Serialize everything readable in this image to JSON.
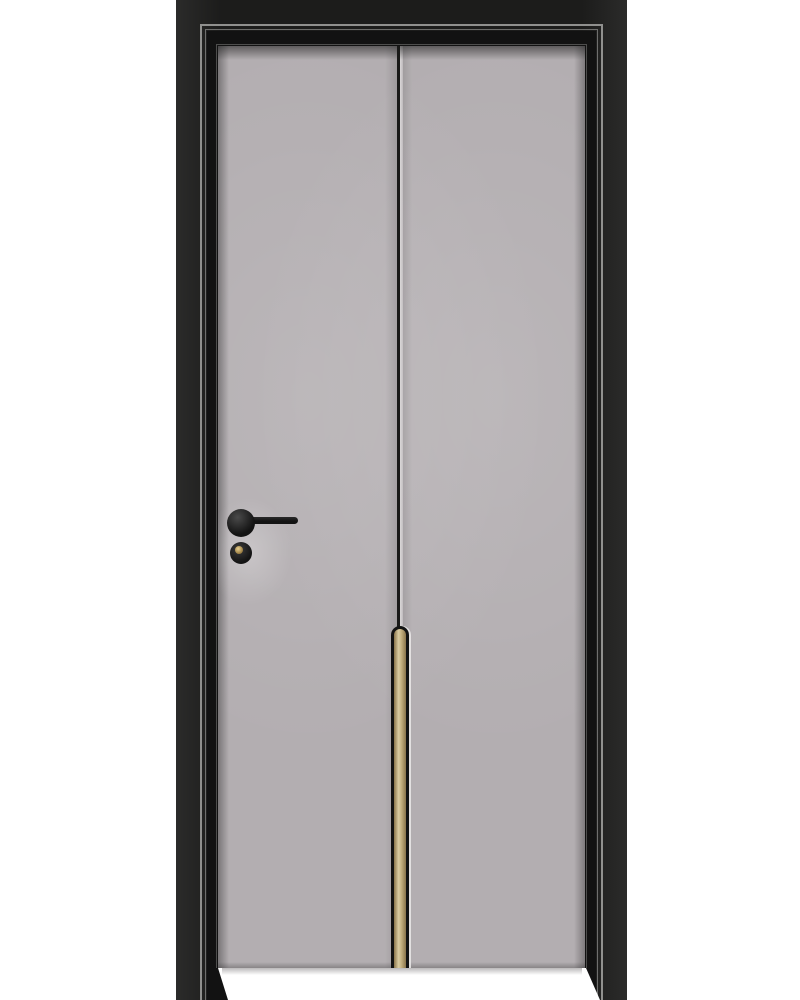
{
  "scene": {
    "type": "product-photo",
    "subject": "Modern interior wooden door with matte grey leaf, black architrave frame, vertical centre groove, brass inlay strip with rounded top, black lever handle and keyed lock cylinder, shown on a plain white background"
  },
  "colors": {
    "background": "#ffffff",
    "frame_dark": "#1c1c1b",
    "frame_outer": "#2b2b2a",
    "frame_inner": "#121212",
    "trim_silver": "#90908e",
    "trim_silver_faint": "#bdbdbb",
    "bevel_grey": "#4e4e4d",
    "door_base": "#b3aeb1",
    "groove_dark": "#191918",
    "groove_light": "#dbd8d9",
    "brass_dark": "#8a744a",
    "brass_mid": "#c2ae7e",
    "brass_light": "#dacca2",
    "hardware_black": "#131313",
    "hardware_sheen": "#4a4a4a",
    "keyhole_gold_light": "#e8d08f",
    "keyhole_gold_dark": "#8d6f35",
    "floor_white": "#ffffff"
  }
}
